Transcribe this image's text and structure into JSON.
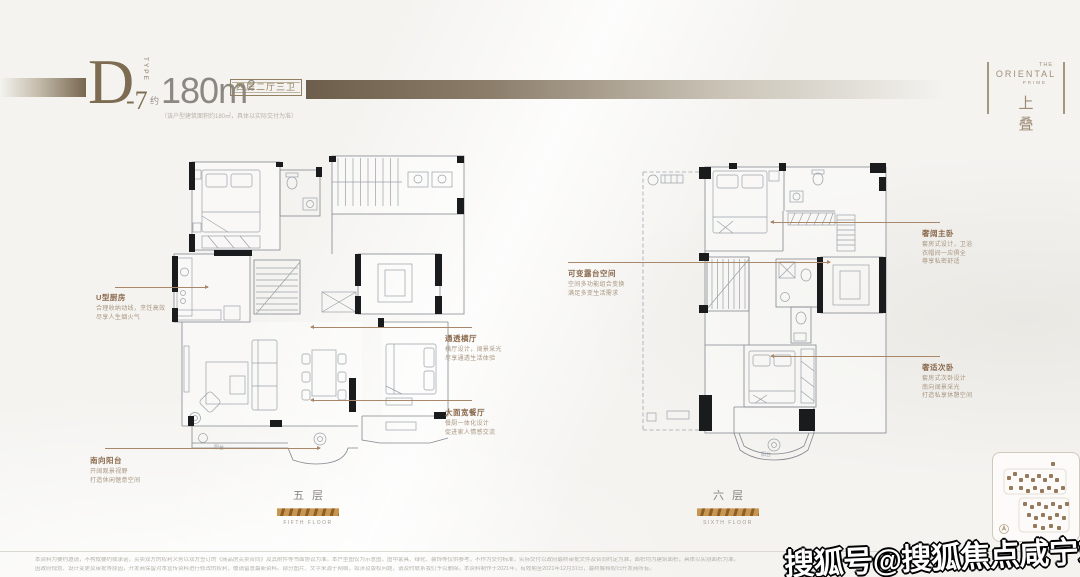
{
  "colors": {
    "bronze": "#8a7560",
    "gold": "#b9854a",
    "leader": "#a8876a",
    "wall": "#1a1b1d"
  },
  "header": {
    "type_letter": "D",
    "type_number": "-7",
    "type_word": "TYPE",
    "area_approx": "约",
    "area_value": "180m",
    "area_sup": "2",
    "area_note": "（该户型建筑面积约180㎡，具体以实际交付为准）",
    "tag": "四房二厅三卫"
  },
  "brand": {
    "the": "THE",
    "oriental": "ORIENTAL",
    "prime": "PRIME",
    "cn": "上 叠"
  },
  "plans": {
    "left": {
      "floor_cn": "五层",
      "floor_en": "FIFTH FLOOR",
      "balcony": "阳台"
    },
    "right": {
      "floor_cn": "六层",
      "floor_en": "SIXTH FLOOR",
      "balcony": "阳台"
    }
  },
  "callouts": {
    "left": [
      {
        "title": "U型厨房",
        "lines": [
          "合理收纳动线，烹饪高效",
          "尽享人生烟火气"
        ]
      },
      {
        "title": "南向阳台",
        "lines": [
          "开阔观景视野",
          "打造休闲惬意空间"
        ]
      },
      {
        "title": "通透横厅",
        "lines": [
          "横厅设计，阔景采光",
          "尽享通透生活体验"
        ]
      },
      {
        "title": "大面宽餐厅",
        "lines": [
          "餐厨一体化设计",
          "促进家人情感交流"
        ]
      }
    ],
    "right": [
      {
        "title": "可变露台空间",
        "lines": [
          "空间多功能组合变换",
          "满足多变生活需求"
        ]
      },
      {
        "title": "奢阔主卧",
        "lines": [
          "套房式设计，卫浴",
          "衣帽间一应俱全",
          "尊享私密舒适"
        ]
      },
      {
        "title": "奢适次卧",
        "lines": [
          "套房式次卧设计",
          "南向阔景采光",
          "打造私享休憩空间"
        ]
      }
    ]
  },
  "footer": {
    "disclaimer1": "本资料为要约邀请，不构成要约或承诺，买卖双方的权利义务以双方签订的《商品房买卖合同》及其附件等书面协议为准。本户型图仅为示意图，图中家具、绿化、装饰等仅供参考，不作为交付标准，实际交付以政府最终审批文件及合同约定为准，面积均为建筑面积，具体以实测面积为准。",
    "disclaimer2": "因政府规划、设计变更及审批等原因，开发商保留对本宣传资料进行修改的权利，敬请留意最新资料。部分图片、文字来源于网络，如涉及版权问题，请及时联系我们予以删除。本资料制作于2021年，有效期至2021年12月31日，最终解释权归开发商所有。"
  },
  "watermark": "搜狐号@搜狐焦点咸宁站"
}
